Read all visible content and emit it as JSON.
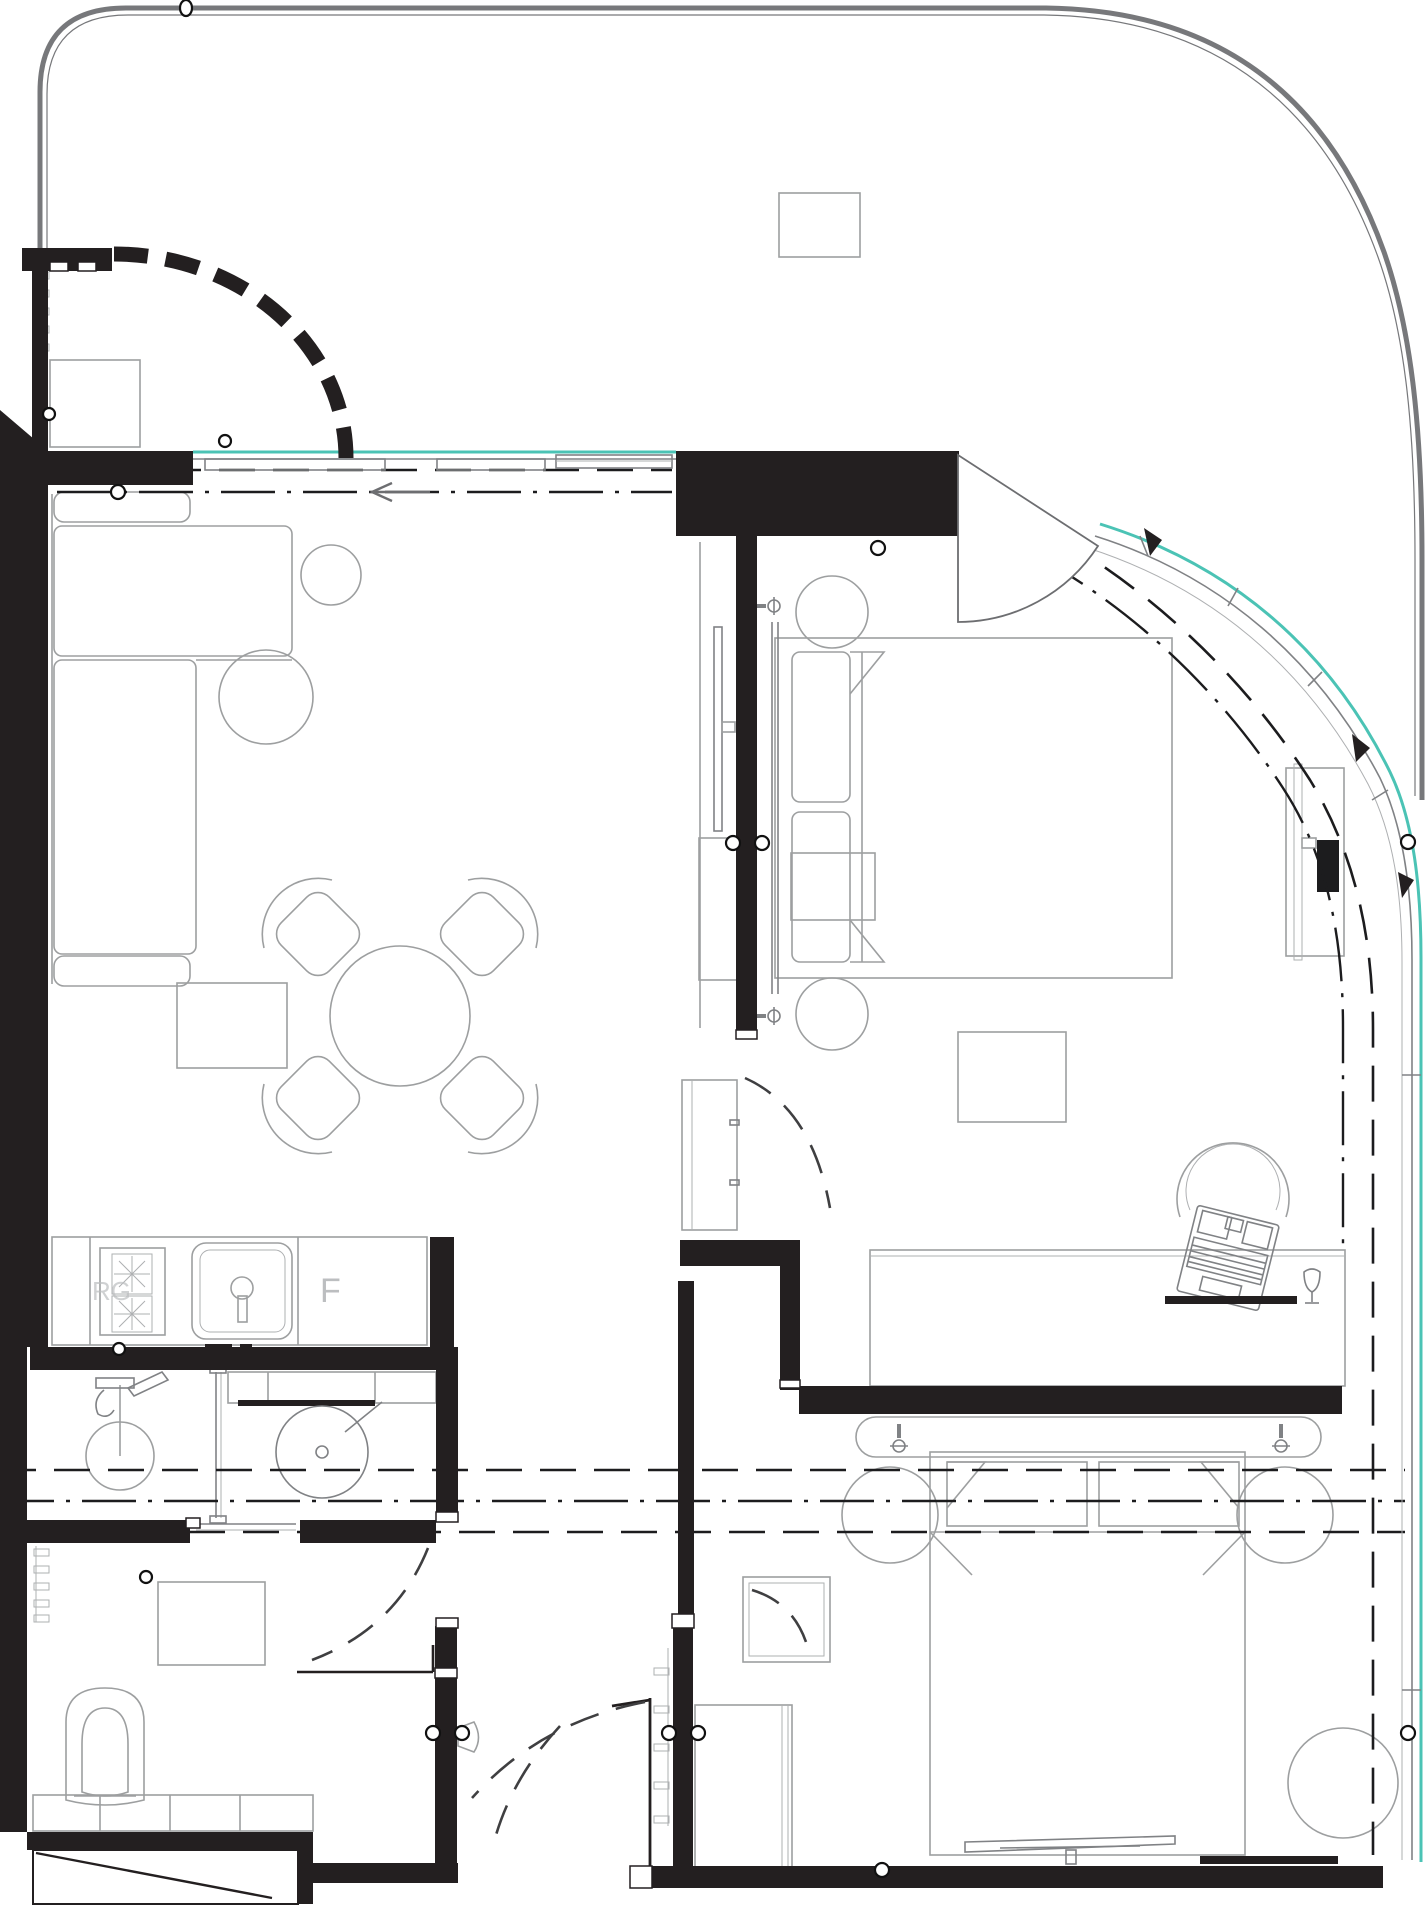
{
  "document": {
    "kind": "architectural floor plan",
    "visible_text_labels": [
      "F",
      "RG"
    ]
  },
  "labels": {
    "fridge": "F",
    "range_marking": "RG"
  },
  "colors": {
    "background": "#ffffff",
    "wall_fill": "#231f20",
    "furniture_stroke": "#9d9fa0",
    "glass_teal": "#4bc3b5",
    "terrace_edge_gray": "#77787b",
    "section_dash": "#1c1c1e",
    "door_swing": "#3f3f41"
  },
  "symbols": [
    "terrace-edge",
    "curved-entry-wall",
    "coat-rack",
    "doormat",
    "sofa",
    "side-table",
    "coffee-table",
    "dining-table",
    "dining-chairs",
    "rug",
    "kitchen-counter",
    "hob-burners",
    "sink",
    "fridge",
    "shower-head",
    "glass-partition",
    "vanity-basin",
    "mirror",
    "toilet",
    "towel-rack",
    "bath-counter",
    "shower-tray",
    "bed",
    "pillows",
    "nightstand",
    "wall-sconce",
    "tv",
    "tv-console",
    "wardrobe",
    "bench",
    "desk",
    "desk-chair",
    "laptop",
    "goblet",
    "window-mullions",
    "window-handle",
    "curtain-dash-line",
    "door-swing-arc",
    "section-line",
    "direction-arrow",
    "reference-circle"
  ]
}
